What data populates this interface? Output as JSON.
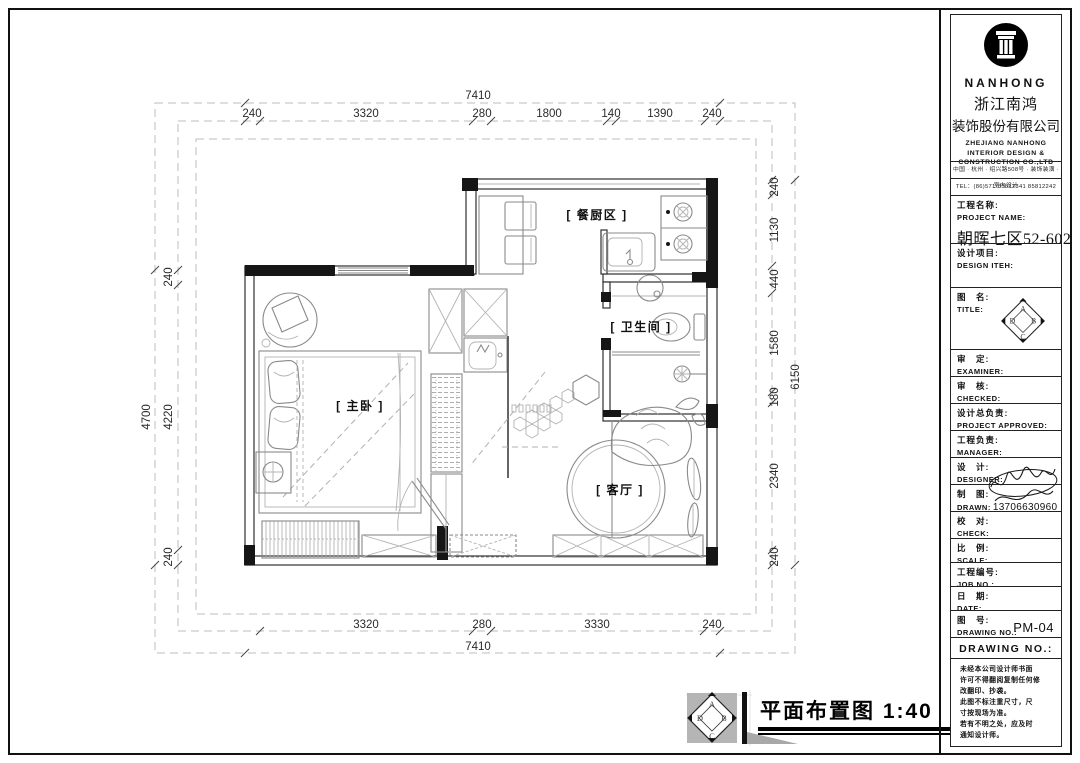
{
  "plan": {
    "scale_title": "平面布置图 1:40",
    "rooms": {
      "kitchen": "[ 餐厨区 ]",
      "bathroom": "[ 卫生间 ]",
      "bedroom": "[ 主卧 ]",
      "living": "[ 客厅 ]"
    },
    "dims": {
      "top_overall": "7410",
      "top": [
        "240",
        "3320",
        "280",
        "1800",
        "140",
        "1390",
        "240"
      ],
      "right": [
        "240",
        "1130",
        "440",
        "1580",
        "180",
        "2340",
        "240"
      ],
      "right_overall": "6150",
      "left": [
        "240",
        "4220",
        "240"
      ],
      "left_overall": "4700",
      "bottom": [
        "3320",
        "280",
        "3330",
        "240"
      ],
      "bottom_overall": "7410"
    }
  },
  "diamond": {
    "a": "A",
    "b": "B",
    "c": "C",
    "d": "D"
  },
  "titleblock": {
    "brand": "NANHONG",
    "company_cn_line1": "浙江南鸿",
    "company_cn_line2": "装饰股份有限公司",
    "company_en_line1": "ZHEJIANG NANHONG",
    "company_en_line2": "INTERIOR DESIGN &",
    "company_en_line3": "CONSTRUCTION CO.,LTD",
    "address": "中国 · 杭州 · 绍兴路508号 · 装饰装潢 · 室内设计",
    "tel": "TEL：(86)571-85812341  85812242",
    "project": {
      "cn": "工程名称:",
      "en": "PROJECT NAME:",
      "value": "朝晖七区52-602"
    },
    "design_item": {
      "cn": "设计项目:",
      "en": "DESIGN ITEH:"
    },
    "title_field": {
      "cn": "图　名:",
      "en": "TITLE:"
    },
    "rows": [
      {
        "cn": "审　定:",
        "en": "EXAMINER:"
      },
      {
        "cn": "审　核:",
        "en": "CHECKED:"
      },
      {
        "cn": "设计总负责:",
        "en": "PROJECT APPROVED:"
      },
      {
        "cn": "工程负责:",
        "en": "MANAGER:"
      },
      {
        "cn": "设　计:",
        "en": "DESIGNER:"
      },
      {
        "cn": "制　图:",
        "en": "DRAWN:",
        "value": "13706630960"
      },
      {
        "cn": "校　对:",
        "en": "CHECK:"
      },
      {
        "cn": "比　例:",
        "en": "SCALE:"
      },
      {
        "cn": "工程编号:",
        "en": "JOB NO.:"
      },
      {
        "cn": "日　期:",
        "en": "DATE:"
      },
      {
        "cn": "图　号:",
        "en": "DRAWING NO.:",
        "value": "PM-04"
      }
    ],
    "drawing_no_header": "DRAWING NO.:",
    "notes": [
      "未经本公司设计师书面",
      "许可不得翻阅复制任何修",
      "改翻印、抄袭。",
      "此图不标注重尺寸，尺",
      "寸按现场为准。",
      "若有不明之处，应及时",
      "通知设计师。"
    ]
  }
}
